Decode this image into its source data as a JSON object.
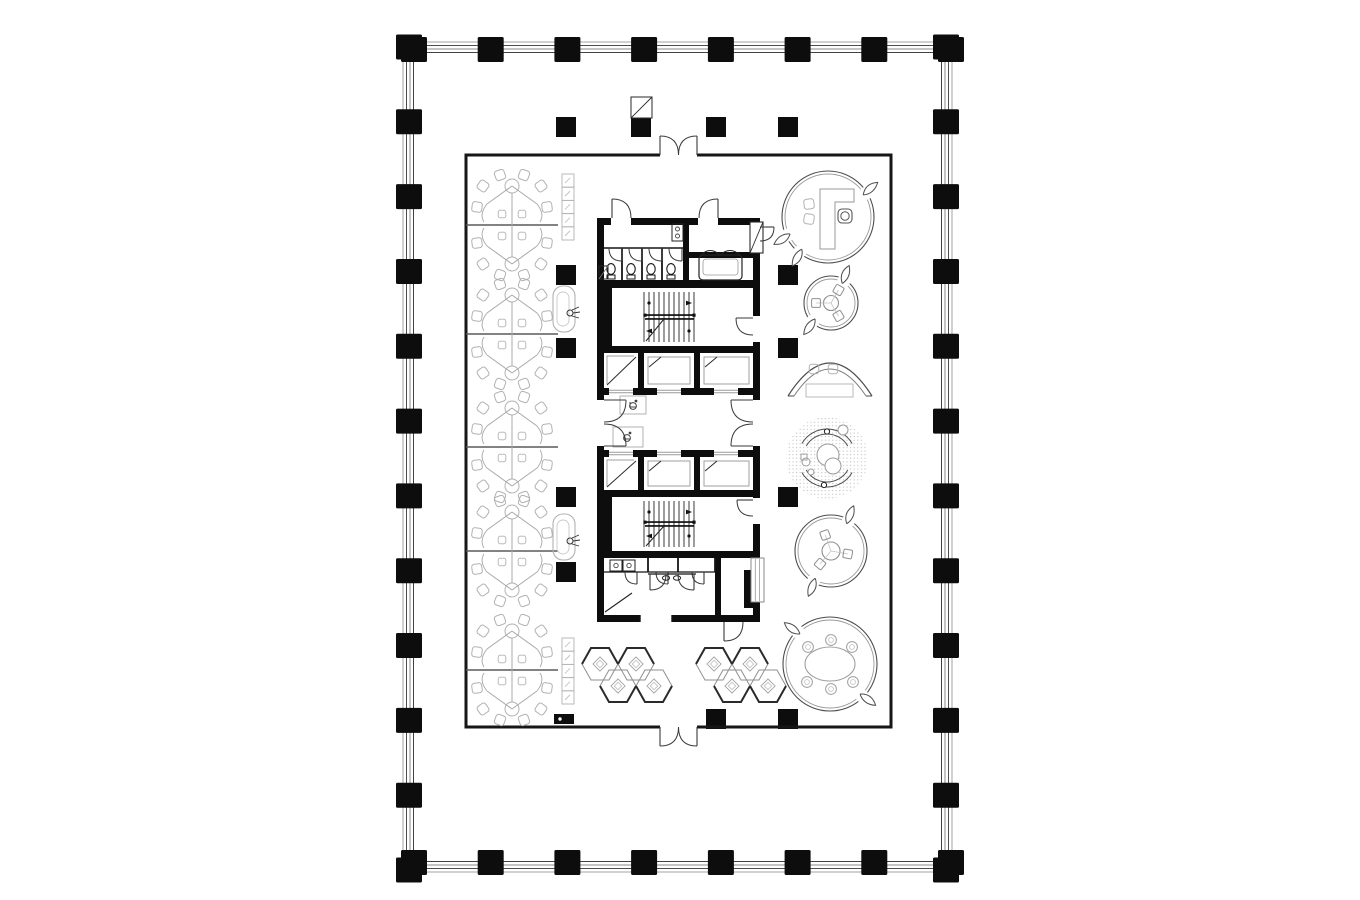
{
  "meta": {
    "background": "#ffffff",
    "ink": "#0d0d0d",
    "wall": "#161616",
    "door": "#3a3a3a",
    "furn_light": "#b2b2b2",
    "furn_mid": "#8f8f8f",
    "furn_dark": "#2a2a2a",
    "shell_line_colors": [
      "#9a9a9a",
      "#3a3a3a",
      "#7c7c7c",
      "#2e2e2e"
    ]
  },
  "canvas": {
    "w": 1360,
    "h": 900
  },
  "shell": {
    "x": 403,
    "y": 42,
    "w": 549,
    "h": 830,
    "insets": [
      0,
      3.5,
      7,
      10.5
    ]
  },
  "perimeter_columns": {
    "top_xs": [
      414,
      490.7,
      567.4,
      644.1,
      720.9,
      797.6,
      874.3,
      951
    ],
    "side_ys": [
      47,
      121.8,
      196.6,
      271.5,
      346.3,
      421.1,
      495.9,
      570.7,
      645.5,
      720.4,
      795.2,
      870
    ],
    "col_w": 26,
    "col_h": 25,
    "top_rect_y": 37,
    "bottom_rect_y": 850,
    "left_rect_x": 396,
    "right_rect_x": 933
  },
  "inner_room": {
    "x1": 466,
    "y1": 155,
    "x2": 891,
    "y2": 727,
    "stroke_w": 3,
    "top_door": {
      "x1": 660,
      "x2": 697
    },
    "bottom_door": {
      "x1": 660,
      "x2": 697
    }
  },
  "interior_columns": {
    "size": 20,
    "points": [
      [
        566,
        127
      ],
      [
        641,
        127
      ],
      [
        716,
        127
      ],
      [
        788,
        127
      ],
      [
        566,
        275
      ],
      [
        788,
        275
      ],
      [
        566,
        348
      ],
      [
        788,
        348
      ],
      [
        566,
        497
      ],
      [
        788,
        497
      ],
      [
        566,
        572
      ],
      [
        716,
        719
      ],
      [
        788,
        719
      ]
    ]
  },
  "riser_shaft": {
    "x": 631,
    "y": 97,
    "w": 21,
    "h": 21
  },
  "floor_box": {
    "x": 554,
    "y": 714,
    "w": 20,
    "h": 10
  },
  "workstations": {
    "cx": 512,
    "centers_y": [
      225,
      334,
      447,
      551,
      670
    ],
    "chairs": [
      [
        -12,
        -50,
        -20
      ],
      [
        12,
        -50,
        20
      ],
      [
        -29,
        -39,
        -55
      ],
      [
        29,
        -39,
        55
      ],
      [
        -35,
        -18,
        -82
      ],
      [
        35,
        -18,
        82
      ],
      [
        -12,
        50,
        200
      ],
      [
        12,
        50,
        160
      ],
      [
        -29,
        39,
        235
      ],
      [
        29,
        39,
        125
      ],
      [
        -35,
        18,
        262
      ],
      [
        35,
        18,
        98
      ]
    ],
    "inner_seats": [
      [
        -10,
        -11
      ],
      [
        10,
        -11
      ],
      [
        -10,
        11
      ],
      [
        10,
        11
      ]
    ]
  },
  "lockers": {
    "w": 12,
    "cell_h": 13.2,
    "cells": 5,
    "positions": [
      [
        562,
        174
      ],
      [
        562,
        638
      ]
    ]
  },
  "print_stations": [
    [
      553,
      286
    ],
    [
      553,
      514
    ]
  ],
  "hex_pods": {
    "group_centers": [
      [
        627,
        675
      ],
      [
        741,
        675
      ]
    ],
    "hex_offsets": [
      [
        -27,
        -11
      ],
      [
        9,
        -11
      ],
      [
        -9,
        11
      ],
      [
        27,
        11
      ]
    ]
  },
  "pods": [
    {
      "kind": "office",
      "cx": 828,
      "cy": 217,
      "r": 46,
      "flares": [
        328,
        156,
        129
      ]
    },
    {
      "kind": "table3",
      "cx": 831,
      "cy": 303,
      "r": 27,
      "flares": [
        300,
        135
      ],
      "table_r": 7.5,
      "seat_d": 15,
      "seat_angles": [
        -60,
        60,
        180
      ]
    },
    {
      "kind": "garden",
      "cx": 827,
      "cy": 458,
      "r": 41
    },
    {
      "kind": "table3",
      "cx": 831,
      "cy": 551,
      "r": 36,
      "flares": [
        300,
        120
      ],
      "table_r": 9,
      "seat_d": 17,
      "seat_angles": [
        -110,
        10,
        130
      ]
    },
    {
      "kind": "table6",
      "cx": 830,
      "cy": 664,
      "r": 47,
      "flares": [
        225,
        45
      ],
      "chairs": [
        [
          808,
          647
        ],
        [
          831,
          640
        ],
        [
          852,
          647
        ],
        [
          807,
          682
        ],
        [
          831,
          689
        ],
        [
          853,
          682
        ]
      ]
    }
  ],
  "crescent": {
    "outer": [
      [
        788,
        396
      ],
      [
        830,
        330
      ],
      [
        872,
        396
      ]
    ],
    "inner": [
      [
        794,
        396
      ],
      [
        830,
        342
      ],
      [
        866,
        396
      ]
    ],
    "chairs": [
      [
        814,
        369
      ],
      [
        833,
        369
      ]
    ],
    "table": {
      "x": 806,
      "y": 384,
      "w": 47,
      "h": 13
    }
  },
  "core": {
    "x1": 597,
    "x2": 760,
    "wt": 7,
    "y_top": 218,
    "y_bottom": 622,
    "toilet": {
      "bottom": 280,
      "wall_h": 8,
      "div_x": 683,
      "front_y": 248,
      "stall_divs": [
        622,
        642,
        662,
        682
      ],
      "toilet_cx": [
        611,
        631,
        651,
        671
      ],
      "sink": {
        "x": 672,
        "y": 224,
        "w": 11,
        "h": 17
      },
      "closet": {
        "x": 599,
        "y": 266,
        "w": 9,
        "h": 13
      }
    },
    "topright": {
      "x": 689,
      "room_bottom": 252,
      "sofa": {
        "x": 699,
        "y": 255,
        "w": 43,
        "h": 25
      }
    },
    "stair1": {
      "y1": 288,
      "y2": 346
    },
    "stair2": {
      "y1": 497,
      "y2": 551
    },
    "elev1": {
      "y1": 353,
      "y2": 388
    },
    "elev2": {
      "y1": 457,
      "y2": 490
    },
    "lobby": {
      "y1": 395,
      "y2": 450,
      "door_y1": 400,
      "door_y2": 446,
      "wc1": {
        "x": 620,
        "y": 396,
        "w": 26,
        "h": 18
      },
      "wc2": {
        "x": 613,
        "y": 427,
        "w": 30,
        "h": 20
      }
    },
    "closets": {
      "y1": 558,
      "y2": 572,
      "div_xs": [
        648,
        678,
        715
      ],
      "door_hinges": [
        637,
        668,
        704
      ]
    },
    "hall": {
      "door_cx": 672,
      "sinks": [
        [
          610,
          560
        ],
        [
          623,
          560
        ]
      ]
    },
    "cabs": [
      [
        604,
        34
      ],
      [
        644,
        50
      ],
      [
        700,
        53
      ]
    ],
    "elev_door_cx": [
      621,
      669,
      726
    ],
    "shaft_black": {
      "x": 744,
      "y": 570,
      "w": 12,
      "h": 38
    },
    "hatch_right": {
      "x": 751,
      "y": 558,
      "w": 13,
      "h": 44
    },
    "shaft_topright": {
      "x": 750,
      "y": 222,
      "w": 13,
      "h": 31
    },
    "bottom_gap": {
      "x": 640,
      "w": 32
    }
  }
}
